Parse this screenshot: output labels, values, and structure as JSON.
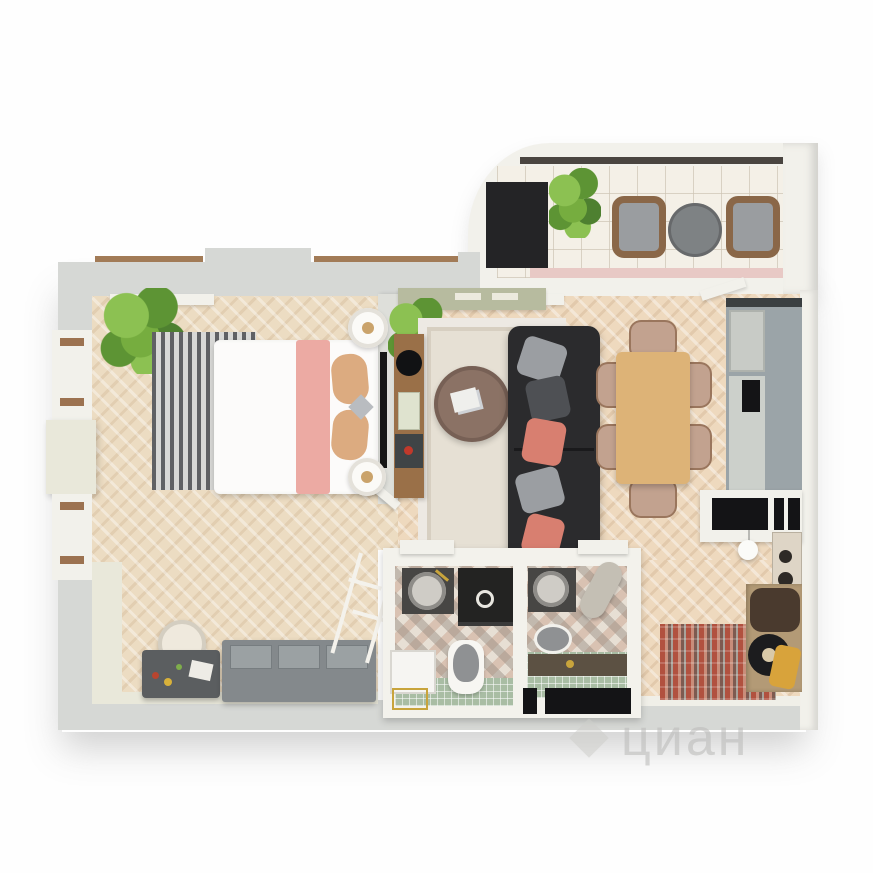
{
  "watermark": {
    "logo": "diamond-icon",
    "text": "циан"
  },
  "palette": {
    "wall_gray": "#d6d8d5",
    "wall_white": "#f2f1eb",
    "wall_inner_cream": "#e9e8da",
    "floor_bedroom": "#ecdcc2",
    "floor_living": "#eed9be",
    "floor_balcony": "#f4f0e7",
    "tile_bath": "#e7dfd4",
    "tile_green": "#a9bda4",
    "rug_stripe_dark": "#606164",
    "rug_stripe_light": "#d8d8d6",
    "rug_living": "#e6e0d4",
    "hall_rug_red": "#b1513f",
    "bed_white": "#fcfbfa",
    "blanket_pink": "#ecaaa3",
    "pillow_tan": "#dcab80",
    "sofa_black": "#2b2b2d",
    "pillow_coral": "#d87f70",
    "pillow_gray": "#9b9ea2",
    "table_wood": "#ddb377",
    "chair_tan": "#c2a28f",
    "coffee_table": "#8b7265",
    "console_wood": "#9a7048",
    "kitchen_gray": "#9ba4a8",
    "cabinet_sage": "#b7bb9f",
    "wardrobe_gray": "#84898c",
    "dresser_gray": "#5b5e60",
    "appliance_black": "#141416",
    "wicker_brown": "#8a6748",
    "cushion_gray": "#9a9da0",
    "balcony_stripe_pink": "#e8c9c5",
    "gold": "#c8a43c",
    "plant_light": "#8cc152",
    "plant_mid": "#76ad3f",
    "plant_dark": "#5d9434",
    "plant_deep": "#4e8030"
  },
  "scene": {
    "type": "3d-floorplan-render",
    "rooms": [
      {
        "name": "balcony",
        "items": [
          "potted-plant",
          "wicker-armchair",
          "round-table",
          "wicker-armchair",
          "dark-niche"
        ]
      },
      {
        "name": "bedroom",
        "items": [
          "potted-plant",
          "striped-rug",
          "double-bed",
          "pink-throw",
          "pillows",
          "nightstand",
          "nightstand",
          "wall-tv",
          "vanity-dresser",
          "vanity-chair",
          "wardrobe",
          "ladder-rack",
          "door-leaf"
        ]
      },
      {
        "name": "living-dining",
        "items": [
          "potted-plant",
          "sage-cabinet",
          "sideboard",
          "sphere-lamp",
          "books",
          "record-player",
          "area-rug",
          "round-coffee-table",
          "sofa",
          "throw-pillows",
          "dining-table",
          "dining-chairs",
          "kitchen-counter",
          "cooktop",
          "built-in-closet",
          "pendant-lamp",
          "stove"
        ]
      },
      {
        "name": "bathroom-1",
        "items": [
          "washbasin",
          "shower",
          "toilet",
          "washing-machine",
          "brass-rack",
          "door-leaf"
        ]
      },
      {
        "name": "bathroom-2",
        "items": [
          "washbasin",
          "water-heater",
          "toilet",
          "dark-vanity",
          "door-leaf"
        ]
      },
      {
        "name": "hallway",
        "items": [
          "runner-rug",
          "coat-rack",
          "pouf",
          "bags",
          "entry-mats"
        ]
      }
    ]
  }
}
